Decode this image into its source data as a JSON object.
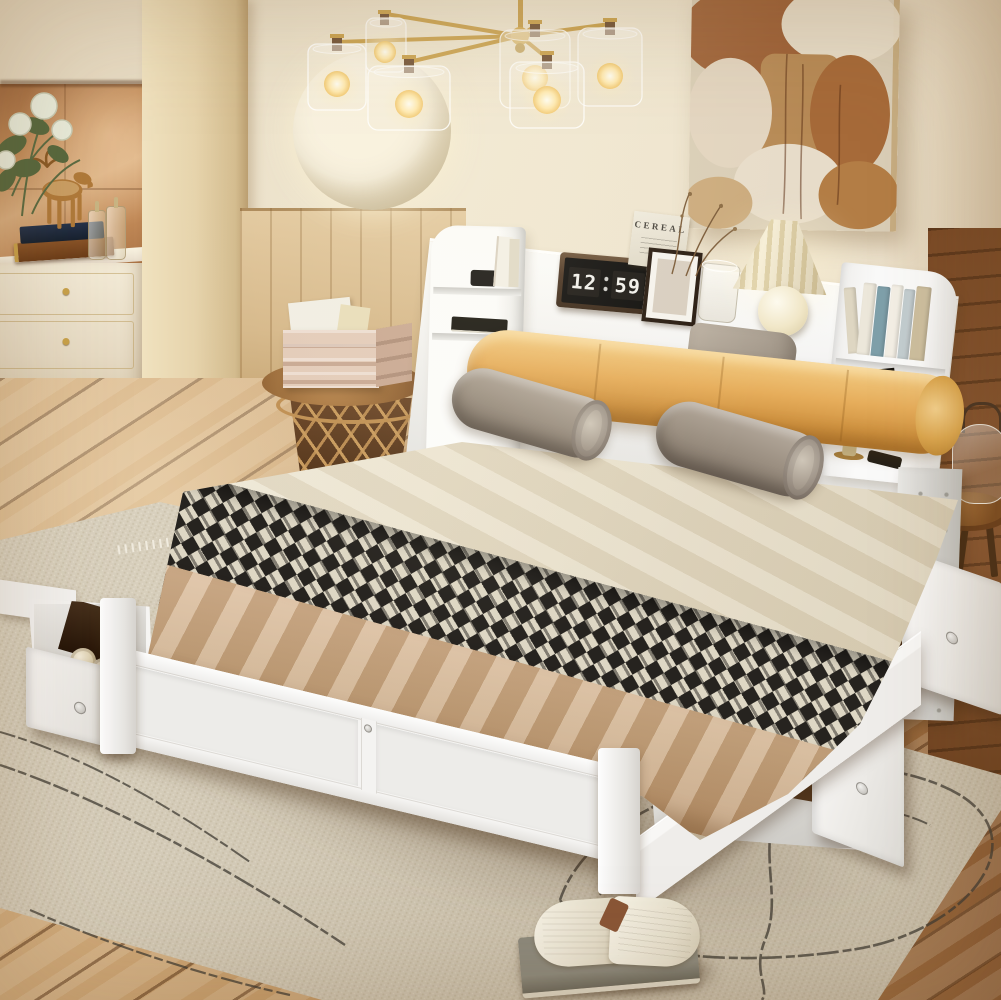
{
  "scene": {
    "type": "bedroom-product-photo",
    "subject": "White full-size storage bed with bookcase headboard, pull-out under-bed drawers, gold chandelier and rustic boho decor"
  },
  "headboard_shelf": {
    "magazine_title": "CEREAL",
    "clock": {
      "hours": "12",
      "minutes": "59"
    }
  },
  "palette": {
    "wall": "#EDE2CC",
    "wood_paneling": "#D6B88A",
    "door_column": "#E6D3AB",
    "copper_wall": "#C08A58",
    "floor": "#C49A68",
    "floor_dark": "#7A4A26",
    "rug": "#DBD3C1",
    "rug_scribble": "#3F3B33",
    "bed_frame_white": "#F5F4F2",
    "mattress_sheet": "#E9E0CA",
    "bolster_tan": "#E6AD5B",
    "pillow_gray": "#9A8E80",
    "throw_houndstooth_dark": "#26231F",
    "throw_houndstooth_light": "#DED7C4",
    "blanket_tan": "#C6A47E",
    "chandelier_gold": "#C89E48",
    "bulb_glow": "#FFE9AD",
    "lamp_cream": "#F2E9CF",
    "clock_body": "#4A3322",
    "painting_rust": "#9A5A2E",
    "moose_gold": "#B07A3A",
    "basket_wire": "#C89A5C",
    "stool_wood": "#8A5A30"
  },
  "objects": [
    {
      "name": "chandelier",
      "label": "6-light gold chandelier with clear glass shades"
    },
    {
      "name": "moon-sconce",
      "label": "round cream wall light behind chandelier"
    },
    {
      "name": "abstract-painting",
      "label": "rust and cream abstract wall art"
    },
    {
      "name": "vintage-dresser",
      "label": "ivory dresser with gold trim"
    },
    {
      "name": "moose-figurine",
      "label": "gold moose figurine on stacked books"
    },
    {
      "name": "apothecary-jars",
      "label": "two small glass jars"
    },
    {
      "name": "white-roses",
      "label": "white rose arrangement"
    },
    {
      "name": "basket-side-table",
      "label": "wire basket side table with wooden top and crate"
    },
    {
      "name": "storage-bed",
      "label": "white platform bed with footboard and side rails"
    },
    {
      "name": "bookcase-headboard",
      "label": "white headboard with open shelves"
    },
    {
      "name": "flip-clock",
      "label": "retro flip clock showing 12:59"
    },
    {
      "name": "picture-frame",
      "label": "dark picture frame with white mat"
    },
    {
      "name": "cereal-magazine",
      "label": "CEREAL magazine leaning on shelf"
    },
    {
      "name": "dried-sprigs",
      "label": "dried stems in glass cup"
    },
    {
      "name": "pleated-lamp",
      "label": "cream pleated table lamp"
    },
    {
      "name": "shelf-books",
      "label": "books on headboard shelves"
    },
    {
      "name": "tan-bolster",
      "label": "camel leather bolster cushion"
    },
    {
      "name": "gray-bolsters",
      "label": "two gray velvet bolster pillows"
    },
    {
      "name": "gray-pillow",
      "label": "gray accent pillow"
    },
    {
      "name": "houndstooth-throw",
      "label": "black and cream houndstooth throw"
    },
    {
      "name": "tan-blanket",
      "label": "camel knit blanket"
    },
    {
      "name": "underbed-drawers",
      "label": "three pull-out storage drawers with books and rolled towels"
    },
    {
      "name": "jute-rug",
      "label": "beige rug with black scribble pattern"
    },
    {
      "name": "open-book",
      "label": "open book lying on rug"
    },
    {
      "name": "wooden-stool",
      "label": "round wooden stool with glass cloche"
    }
  ]
}
